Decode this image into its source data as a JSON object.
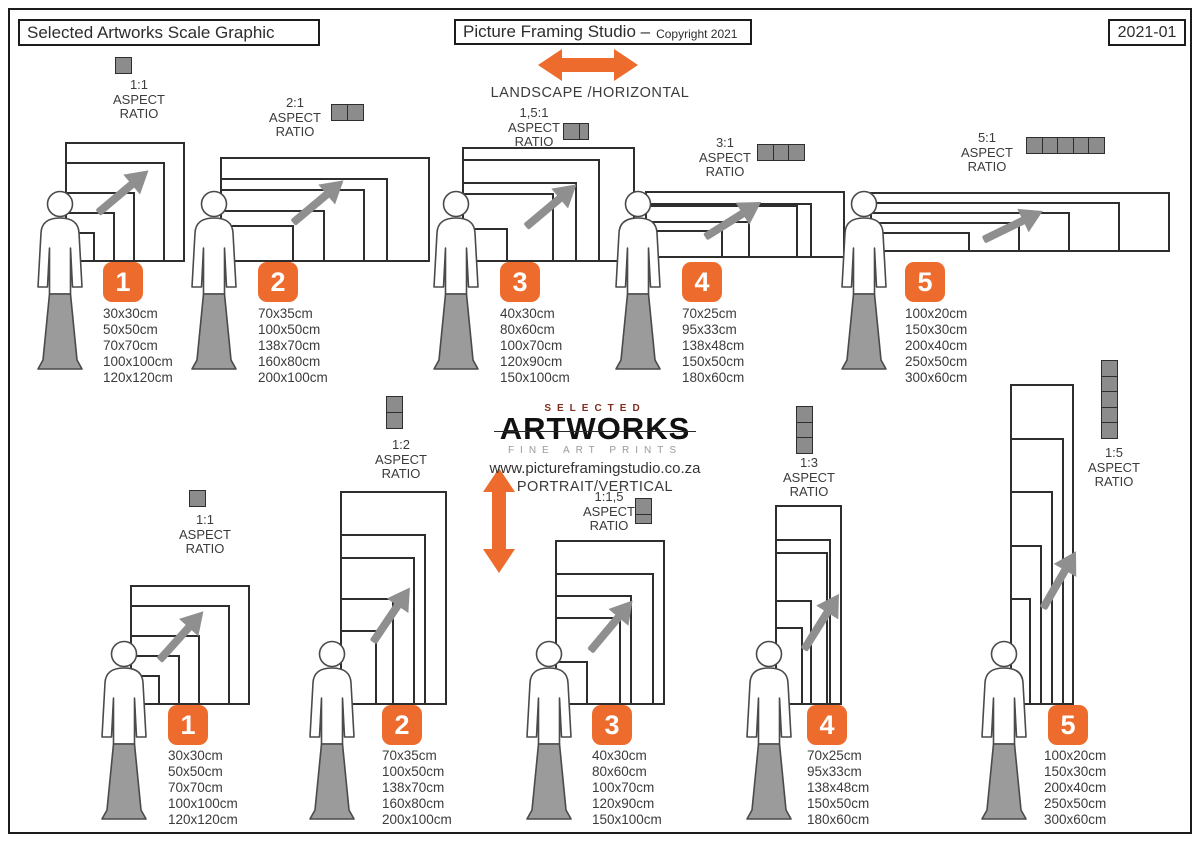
{
  "header": {
    "left": "Selected Artworks Scale Graphic",
    "center_main": "Picture Framing Studio –",
    "center_small": "Copyright 2021",
    "right": "2021-01"
  },
  "center": {
    "landscape_label": "LANDSCAPE /HORIZONTAL",
    "portrait_label": "PORTRAIT/VERTICAL",
    "logo_selected": "SELECTED",
    "logo_artworks": "ARTWORKS",
    "logo_sub": "FINE ART PRINTS",
    "website": "www.pictureframingstudio.co.za"
  },
  "aspect_words": [
    "ASPECT",
    "RATIO"
  ],
  "colors": {
    "accent_orange": "#ED6B2C",
    "gray_fill": "#8C8C8C",
    "arrow_gray": "#8F8F8F",
    "text": "#3B3B3B",
    "logo_red": "#7E2D1E",
    "border": "#1C1C1C"
  },
  "groups": {
    "landscape": [
      {
        "number": "1",
        "ratio": "1:1",
        "icon_units": 1,
        "sizes": [
          "30x30cm",
          "50x50cm",
          "70x70cm",
          "100x100cm",
          "120x120cm"
        ],
        "dims": [
          [
            30,
            30
          ],
          [
            50,
            50
          ],
          [
            70,
            70
          ],
          [
            100,
            100
          ],
          [
            120,
            120
          ]
        ]
      },
      {
        "number": "2",
        "ratio": "2:1",
        "icon_units": 2,
        "sizes": [
          "70x35cm",
          "100x50cm",
          "138x70cm",
          "160x80cm",
          "200x100cm"
        ],
        "dims": [
          [
            70,
            35
          ],
          [
            100,
            50
          ],
          [
            138,
            70
          ],
          [
            160,
            80
          ],
          [
            200,
            100
          ]
        ]
      },
      {
        "number": "3",
        "ratio": "1,5:1",
        "icon_units": 1.5,
        "sizes": [
          "40x30cm",
          "80x60cm",
          "100x70cm",
          "120x90cm",
          "150x100cm"
        ],
        "dims": [
          [
            40,
            30
          ],
          [
            80,
            60
          ],
          [
            100,
            70
          ],
          [
            120,
            90
          ],
          [
            150,
            100
          ]
        ]
      },
      {
        "number": "4",
        "ratio": "3:1",
        "icon_units": 3,
        "sizes": [
          "70x25cm",
          "95x33cm",
          "138x48cm",
          "150x50cm",
          "180x60cm"
        ],
        "dims": [
          [
            70,
            25
          ],
          [
            95,
            33
          ],
          [
            138,
            48
          ],
          [
            150,
            50
          ],
          [
            180,
            60
          ]
        ]
      },
      {
        "number": "5",
        "ratio": "5:1",
        "icon_units": 5,
        "sizes": [
          "100x20cm",
          "150x30cm",
          "200x40cm",
          "250x50cm",
          "300x60cm"
        ],
        "dims": [
          [
            100,
            20
          ],
          [
            150,
            30
          ],
          [
            200,
            40
          ],
          [
            250,
            50
          ],
          [
            300,
            60
          ]
        ]
      }
    ],
    "portrait": [
      {
        "number": "1",
        "ratio": "1:1",
        "icon_units": 1,
        "sizes": [
          "30x30cm",
          "50x50cm",
          "70x70cm",
          "100x100cm",
          "120x120cm"
        ],
        "dims": [
          [
            30,
            30
          ],
          [
            50,
            50
          ],
          [
            70,
            70
          ],
          [
            100,
            100
          ],
          [
            120,
            120
          ]
        ]
      },
      {
        "number": "2",
        "ratio": "1:2",
        "icon_units": 2,
        "sizes": [
          "70x35cm",
          "100x50cm",
          "138x70cm",
          "160x80cm",
          "200x100cm"
        ],
        "dims": [
          [
            35,
            70
          ],
          [
            50,
            100
          ],
          [
            70,
            138
          ],
          [
            80,
            160
          ],
          [
            100,
            200
          ]
        ]
      },
      {
        "number": "3",
        "ratio": "1:1,5",
        "icon_units": 1.5,
        "sizes": [
          "40x30cm",
          "80x60cm",
          "100x70cm",
          "120x90cm",
          "150x100cm"
        ],
        "dims": [
          [
            30,
            40
          ],
          [
            60,
            80
          ],
          [
            70,
            100
          ],
          [
            90,
            120
          ],
          [
            100,
            150
          ]
        ]
      },
      {
        "number": "4",
        "ratio": "1:3",
        "icon_units": 3,
        "sizes": [
          "70x25cm",
          "95x33cm",
          "138x48cm",
          "150x50cm",
          "180x60cm"
        ],
        "dims": [
          [
            25,
            70
          ],
          [
            33,
            95
          ],
          [
            48,
            138
          ],
          [
            50,
            150
          ],
          [
            60,
            180
          ]
        ]
      },
      {
        "number": "5",
        "ratio": "1:5",
        "icon_units": 5,
        "sizes": [
          "100x20cm",
          "150x30cm",
          "200x40cm",
          "250x50cm",
          "300x60cm"
        ],
        "dims": [
          [
            20,
            100
          ],
          [
            30,
            150
          ],
          [
            40,
            200
          ],
          [
            50,
            250
          ],
          [
            60,
            300
          ]
        ]
      }
    ]
  }
}
